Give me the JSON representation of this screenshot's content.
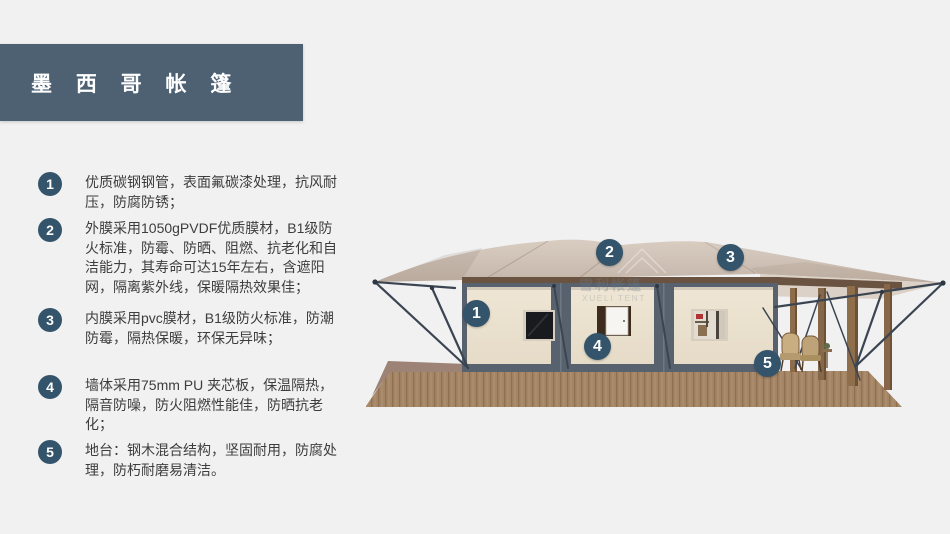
{
  "page": {
    "background": "#f1f1f2"
  },
  "header": {
    "title": "墨 西 哥 帐 篷",
    "bg_color": "#4d6173",
    "text_color": "#ffffff"
  },
  "features": [
    {
      "num": "1",
      "text": "优质碳钢钢管，表面氟碳漆处理，抗风耐压，防腐防锈；"
    },
    {
      "num": "2",
      "text": "外膜采用1050gPVDF优质膜材，B1级防火标准，防霉、防晒、阻燃、抗老化和自洁能力，其寿命可达15年左右，含遮阳网，隔离紫外线，保暖隔热效果佳；"
    },
    {
      "num": "3",
      "text": "内膜采用pvc膜材，B1级防火标准，防潮防霉，隔热保暖，环保无异味；"
    },
    {
      "num": "4",
      "text": "墙体采用75mm PU 夹芯板，保温隔热，隔音防噪，防火阻燃性能佳，防晒抗老化；"
    },
    {
      "num": "5",
      "text": "地台：钢木混合结构，坚固耐用，防腐处理，防朽耐磨易清洁。"
    }
  ],
  "diagram": {
    "markers": [
      {
        "num": "1"
      },
      {
        "num": "2"
      },
      {
        "num": "3"
      },
      {
        "num": "4"
      },
      {
        "num": "5"
      }
    ],
    "watermark": {
      "cn": "雪利帐篷",
      "en": "XUELI TENT"
    },
    "colors": {
      "marker": "#33546a",
      "badge": "#33546a",
      "canopy": "#cec0b5",
      "wall": "#ece3d2",
      "frame": "#58626f",
      "deck": "#ab8b6c",
      "beam": "#6b5341",
      "post": "#8d6c4b",
      "wire": "#3b4552"
    }
  }
}
